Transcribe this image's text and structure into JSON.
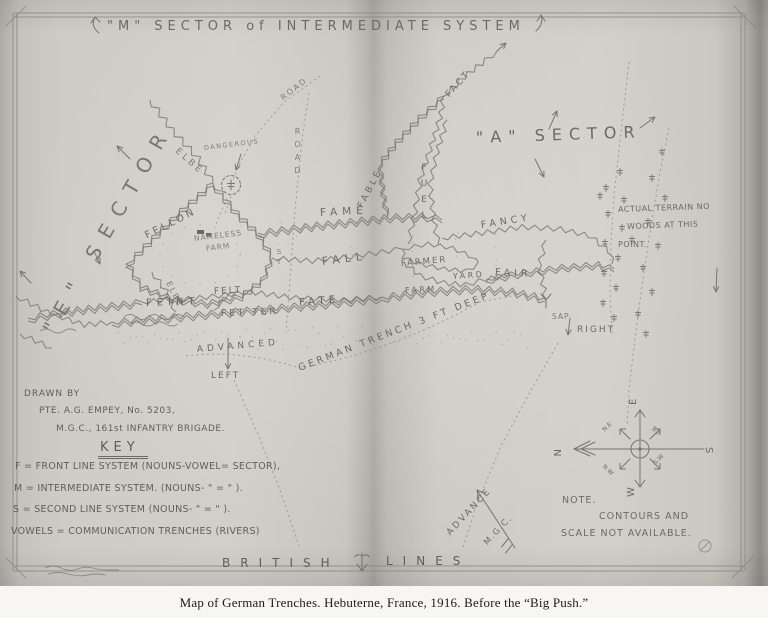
{
  "caption": "Map of German Trenches.   Hebuterne, France, 1916.   Before the “Big Push.”",
  "labels": {
    "title_top": "\"M\" SECTOR of INTERMEDIATE SYSTEM",
    "sector_e": "\"E\" SECTOR",
    "sector_a": "\"A\" SECTOR",
    "elbe_upper": "ELBE",
    "elbe_lower": "ELBE",
    "dangerous": "DANGEROUS",
    "road_diag": "ROAD",
    "road_vert": "ROAD",
    "st": "ST",
    "fact": "FACT",
    "fame": "FAME",
    "fable": "FABLE",
    "fuel": "FUEL",
    "fancy": "FANCY",
    "fall": "FALL",
    "fellon": "FELLON",
    "nameless_1": "NAMELESS",
    "nameless_2": "FARM",
    "feint": "FEINT",
    "felt": "FELT,",
    "fetter": "FET TER",
    "fate": "FATE",
    "farmer": "FARMER",
    "farm": "FARM",
    "yard": "YARD",
    "fair": "FAIR",
    "sap": "SAP",
    "right": "RIGHT",
    "left": "LEFT",
    "advanced": "ADVANCED",
    "german_trench": "GERMAN TRENCH 3 FT DEEP",
    "terrain_1": "ACTUAL TERRAIN NO",
    "terrain_2": "WOODS AT THIS",
    "terrain_3": "POINT.",
    "note_1": "NOTE.",
    "note_2": "CONTOURS AND",
    "note_3": "SCALE NOT AVAILABLE.",
    "british": "BRITISH",
    "lines": "LINES",
    "advance": "ADVANCE",
    "mgc": "M.G.C."
  },
  "credits": {
    "drawn_by_1": "DRAWN BY",
    "drawn_by_2": "PTE. A.G. EMPEY, No. 5203,",
    "drawn_by_3": "M.G.C., 161st INFANTRY BRIGADE.",
    "key_title": "KEY",
    "key_lines": [
      "F = FRONT LINE SYSTEM (NOUNS-VOWEL= SECTOR),",
      "M = INTERMEDIATE SYSTEM. (NOUNS- \" =  \" ).",
      "S = SECOND LINE SYSTEM (NOUNS- \" =  \" ).",
      "VOWELS = COMMUNICATION TRENCHES (RIVERS)"
    ]
  },
  "compass": {
    "n": "N",
    "e": "E",
    "s": "S",
    "w": "W",
    "ne": "N.E",
    "se": "S.E",
    "nw": "N.W",
    "sw": "S.W"
  }
}
